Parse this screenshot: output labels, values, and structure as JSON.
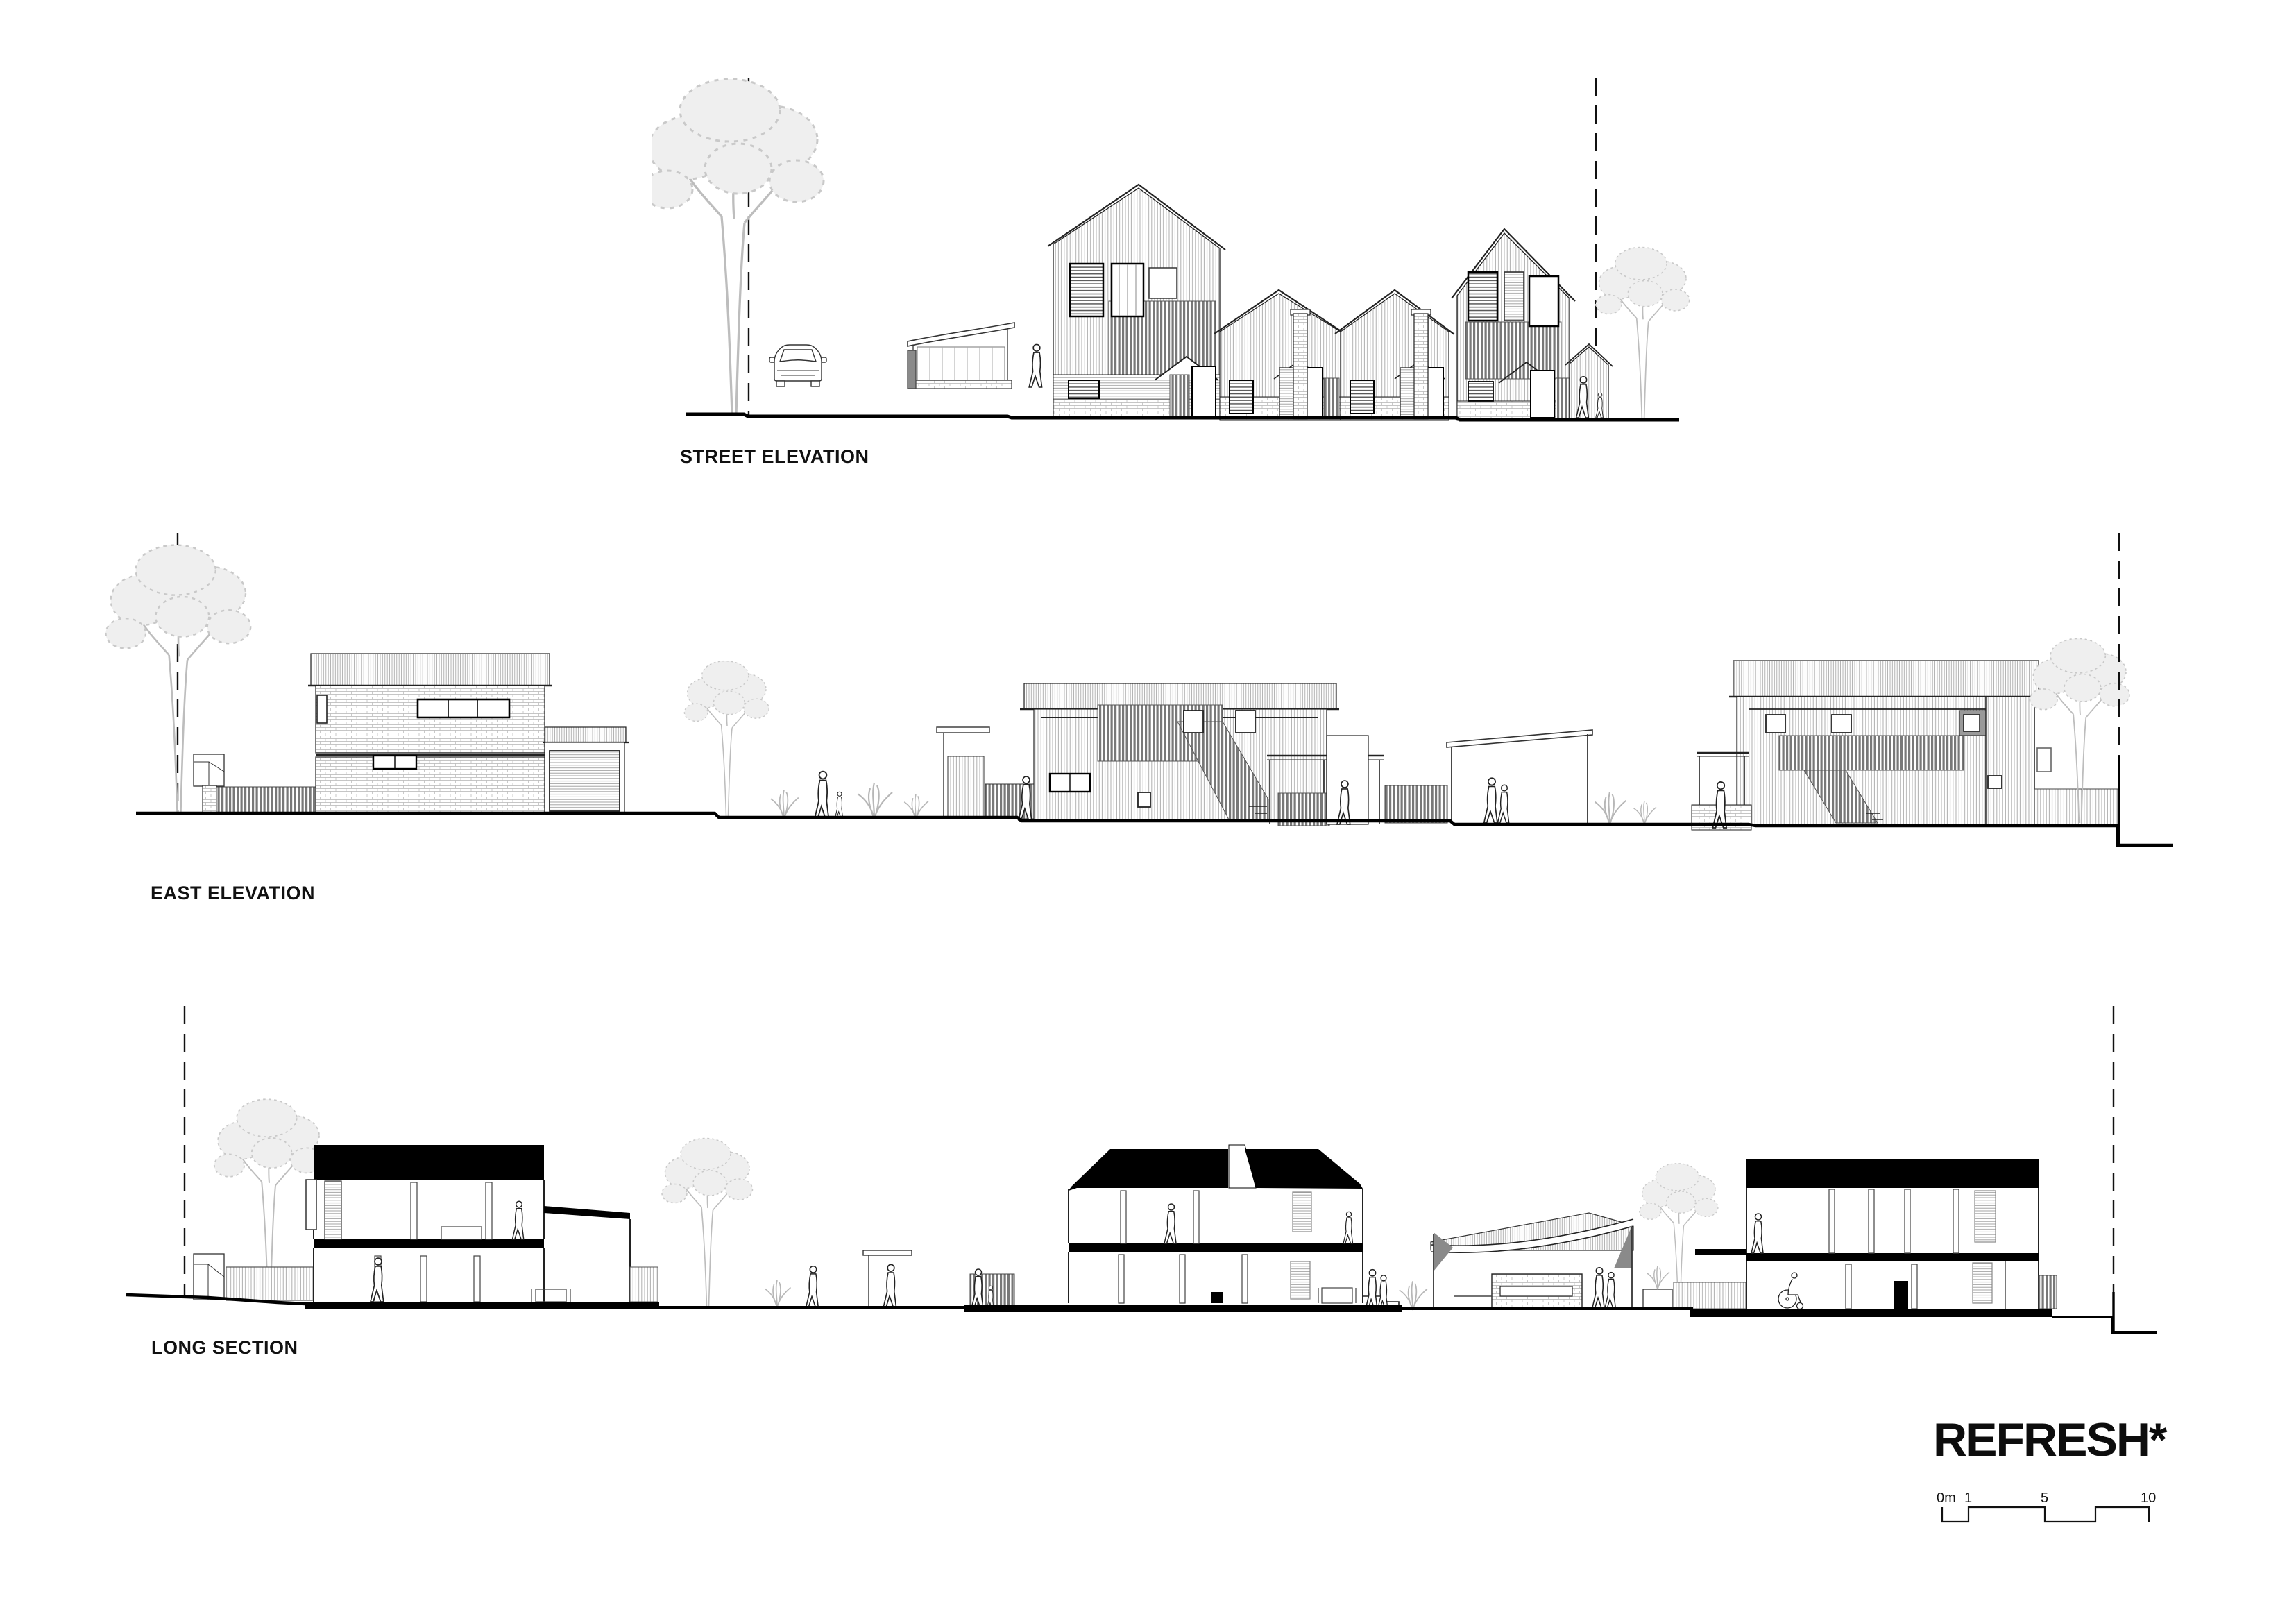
{
  "sheet": {
    "background": "#ffffff",
    "line_color": "#1f1f1f",
    "poche_color": "#000000",
    "tree_color": "#c6c6c6",
    "screen_gray": "#787878"
  },
  "drawings": [
    {
      "id": "street-elevation",
      "label": "STREET ELEVATION"
    },
    {
      "id": "east-elevation",
      "label": "EAST ELEVATION"
    },
    {
      "id": "long-section",
      "label": "LONG SECTION"
    }
  ],
  "logo": {
    "text": "REFRESH*"
  },
  "scalebar": {
    "labels": [
      "0m",
      "1",
      "5",
      "10"
    ]
  }
}
